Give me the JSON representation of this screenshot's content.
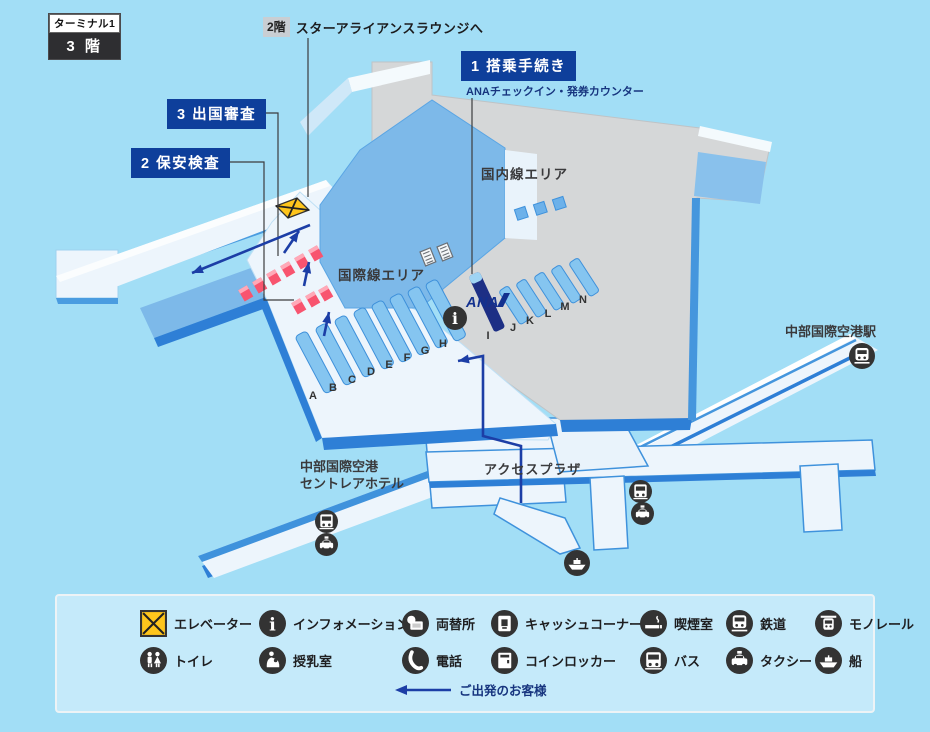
{
  "floor_badge": {
    "terminal": "ターミナル1",
    "floor": "3 階"
  },
  "lounge_note": {
    "badge": "2階",
    "text": "スターアライアンスラウンジへ"
  },
  "callouts": {
    "checkin": {
      "text": "1 搭乗手続き",
      "sub": "ANAチェックイン・発券カウンター"
    },
    "security": {
      "text": "2 保安検査"
    },
    "immigration": {
      "text": "3 出国審査"
    }
  },
  "areas": {
    "domestic": "国内線エリア",
    "international": "国際線エリア",
    "station": "中部国際空港駅",
    "hotel_line1": "中部国際空港",
    "hotel_line2": "セントレアホテル",
    "access_plaza": "アクセスプラザ",
    "ana_logo": "ANA"
  },
  "counters": {
    "international_letters": [
      "A",
      "B",
      "C",
      "D",
      "E",
      "F",
      "G",
      "H"
    ],
    "domestic_letters": [
      "I",
      "J",
      "K",
      "L",
      "M",
      "N"
    ]
  },
  "legend": {
    "rows": [
      [
        {
          "icon": "elevator-icon",
          "label": "エレベーター"
        },
        {
          "icon": "info-icon",
          "label": "インフォメーション"
        },
        {
          "icon": "exchange-icon",
          "label": "両替所"
        },
        {
          "icon": "atm-icon",
          "label": "キャッシュコーナー"
        },
        {
          "icon": "smoking-icon",
          "label": "喫煙室"
        },
        {
          "icon": "train-icon",
          "label": "鉄道"
        },
        {
          "icon": "monorail-icon",
          "label": "モノレール"
        }
      ],
      [
        {
          "icon": "toilet-icon",
          "label": "トイレ"
        },
        {
          "icon": "nursing-icon",
          "label": "授乳室"
        },
        {
          "icon": "phone-icon",
          "label": "電話"
        },
        {
          "icon": "locker-icon",
          "label": "コインロッカー"
        },
        {
          "icon": "bus-icon",
          "label": "バス"
        },
        {
          "icon": "taxi-icon",
          "label": "タクシー"
        },
        {
          "icon": "ship-icon",
          "label": "船"
        }
      ]
    ],
    "departure_note": "ご出発のお客様"
  },
  "colors": {
    "background": "#a2def6",
    "callout_navy": "#0e3f9b",
    "arrow_navy": "#1c3ea6",
    "floor_white": "#edf5fc",
    "floor_gray": "#d5d7d8",
    "roof_blue": "#7db9e9",
    "edge_blue": "#2e7fd6",
    "counter_blue": "#85c5f0",
    "ana_navy": "#1d2f85",
    "gate_pink": "#f8546f",
    "elevator_yellow": "#fec51c",
    "icon_dark": "#333333",
    "legend_bg": "#c5eafa"
  }
}
